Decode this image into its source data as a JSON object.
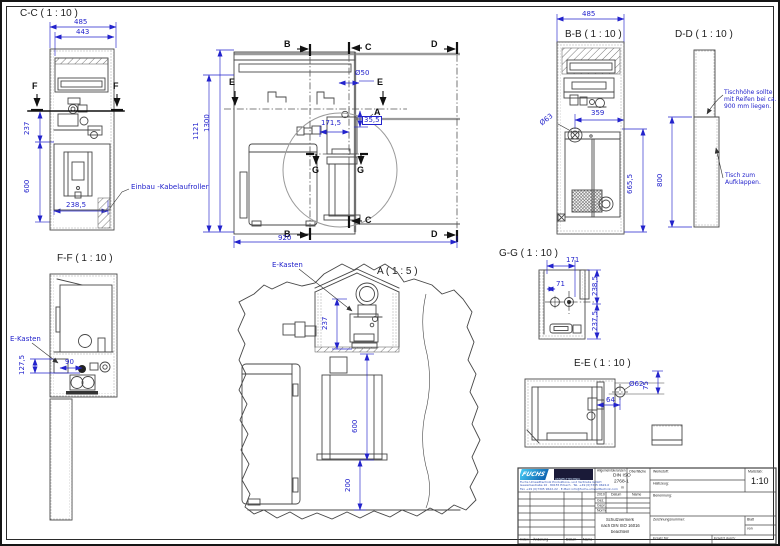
{
  "page": {
    "background": "#ffffff",
    "line_color": "#474747",
    "dimension_color": "#2323cc"
  },
  "views": {
    "cc": {
      "title": "C-C ( 1 : 10 )",
      "dim_485": "485",
      "dim_443": "443",
      "dim_237": "237",
      "dim_600": "600",
      "dim_238_5": "238,5",
      "marker_f": "F",
      "label_kabelaufroller": "Einbau -Kabelaufroller"
    },
    "main": {
      "marker_b": "B",
      "marker_c": "C",
      "marker_d": "D",
      "marker_e": "E",
      "marker_g": "G",
      "detail_a": "A",
      "dim_o50": "Ø50",
      "dim_35_5": "35,5",
      "dim_171_5": "171,5",
      "dim_1121": "1121",
      "dim_1300": "1300",
      "dim_920": "920"
    },
    "bb": {
      "title": "B-B ( 1 : 10 )",
      "dim_485": "485",
      "dim_o63": "Ø63",
      "dim_359": "359",
      "dim_665_5": "665,5"
    },
    "dd": {
      "title": "D-D ( 1 : 10 )",
      "dim_800": "800",
      "note_height": "Tischhöhe sollte mit Reifen bei ca. 900 mm liegen.",
      "note_fold": "Tisch zum Aufklappen."
    },
    "ff": {
      "title": "F-F ( 1 : 10 )",
      "label_ekasten": "E-Kasten",
      "dim_127_5": "127,5",
      "dim_90": "90"
    },
    "a": {
      "title": "A ( 1 : 5 )",
      "label_ekasten": "E-Kasten",
      "dim_237": "237",
      "dim_600": "600",
      "dim_200": "200"
    },
    "gg": {
      "title": "G-G ( 1 : 10 )",
      "dim_171": "171",
      "dim_71": "71",
      "dim_238_5": "238,5",
      "dim_237_5": "237,5"
    },
    "ee": {
      "title": "E-E ( 1 : 10 )",
      "dim_75": "75",
      "dim_o62": "Ø62",
      "dim_64": "64"
    }
  },
  "title_block": {
    "logo_text": "FUCHS",
    "logo_sub": "UMWELTTECHNIK",
    "company_line1": "Fuchs Umwelttechnik Produktions- und Vertriebs GmbH",
    "company_line2": "Gewerbestraße 10 · 89155 Erbach · Tel. +49 (0)7305 9622-0",
    "company_line3": "Fax +49 (0)7305 9622-22 · E-Mail: info@fuchs-umwelttechnik.com",
    "tolerance_label": "Allgemeintoleranzen",
    "tolerance_std1": "DIN ISO",
    "tolerance_std2": "2768-1",
    "tolerance_class": "m",
    "surface_label": "Oberfläche",
    "material_label": "Werkstoff:",
    "semifinished_label": "Halbzeug:",
    "scale_label": "Maßstab:",
    "scale_value": "1:10",
    "name_label": "Benennung:",
    "drawing_no_label": "Zeichnungsnummer:",
    "sheet_label": "Blatt",
    "of_label": "von",
    "replacement_for_label": "Ersatz für:",
    "replaced_by_label": "Ersetzt durch:",
    "protect_l1": "Schutzvermerk",
    "protect_l2": "nach DIN ISO 16016",
    "protect_l3": "beachten!",
    "header_rev": "2010",
    "header_date": "Datum",
    "header_name": "Name",
    "row_drawn": "Gez.",
    "row_checked": "Gepr.",
    "row_norm": "Norm",
    "footer_index": "Index",
    "footer_change": "Änderung",
    "footer_date": "Datum",
    "footer_name": "Name"
  }
}
